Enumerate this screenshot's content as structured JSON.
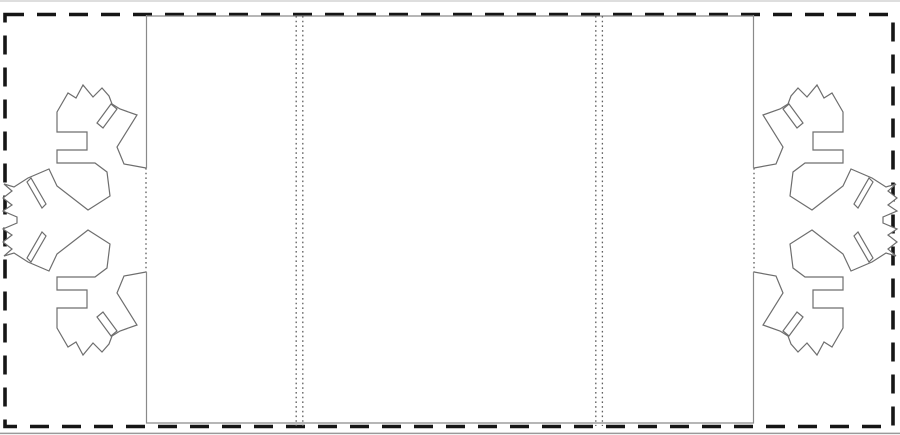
{
  "document": {
    "type": "snowflake-card-cutting-template",
    "description": "Printable papercraft template: outer dashed cut border, central tri-panel card with valley fold lines, and two fold-out paper-cut snowflakes attached at the card side edges",
    "visible_text": ""
  },
  "colors": {
    "paper_fill": "#ffffff",
    "cut_border": "#161616",
    "panel_line": "#8a8a8a",
    "snowflake_line": "#6e6e6e",
    "fold_dots": "#5e5e5e",
    "page_edge_top": "#c9c9c9",
    "page_edge_bottom": "#9a9a9a"
  },
  "outer_border": {
    "dash_pattern": "19 13",
    "stroke_width": "3.6"
  },
  "fold_lines": {
    "dot_pattern": "1.6 3.1",
    "stroke_width": "1.3"
  },
  "snowflake": {
    "stroke_width": "1.2",
    "outline_path": "M146,168 L124,164 L117,147 L137,115 L120,109 L112,104 L109,96 L102,88 L93,97 L83,85 L76,98 L68,93 L57,112 L57,132 L87,132 L87,150 L57,150 L57,163 L95,163 L107,172 L110,196 L88,210 L57,186 L49,169 L28,178 L14,187 L4,184 L12,191 L3,198 L12,205 L3,211 L17,217 L17,223 L3,229 L12,235 L3,242 L12,249 L4,256 L14,253 L28,262 L49,271 L57,254 L88,230 L110,244 L107,268 L95,277 L57,277 L57,290 L87,290 L87,308 L57,308 L57,328 L68,347 L76,342 L83,355 L93,343 L102,352 L109,344 L112,336 L120,331 L137,325 L117,293 L124,276 L146,272",
    "slit_paths": "M111,104 L117,109 L103,128 L97,123 Z M27,182 L31,178 L46,204 L42,208 Z M111,336 L117,331 L103,312 L97,317 Z M27,258 L31,262 L46,236 L42,232 Z"
  }
}
